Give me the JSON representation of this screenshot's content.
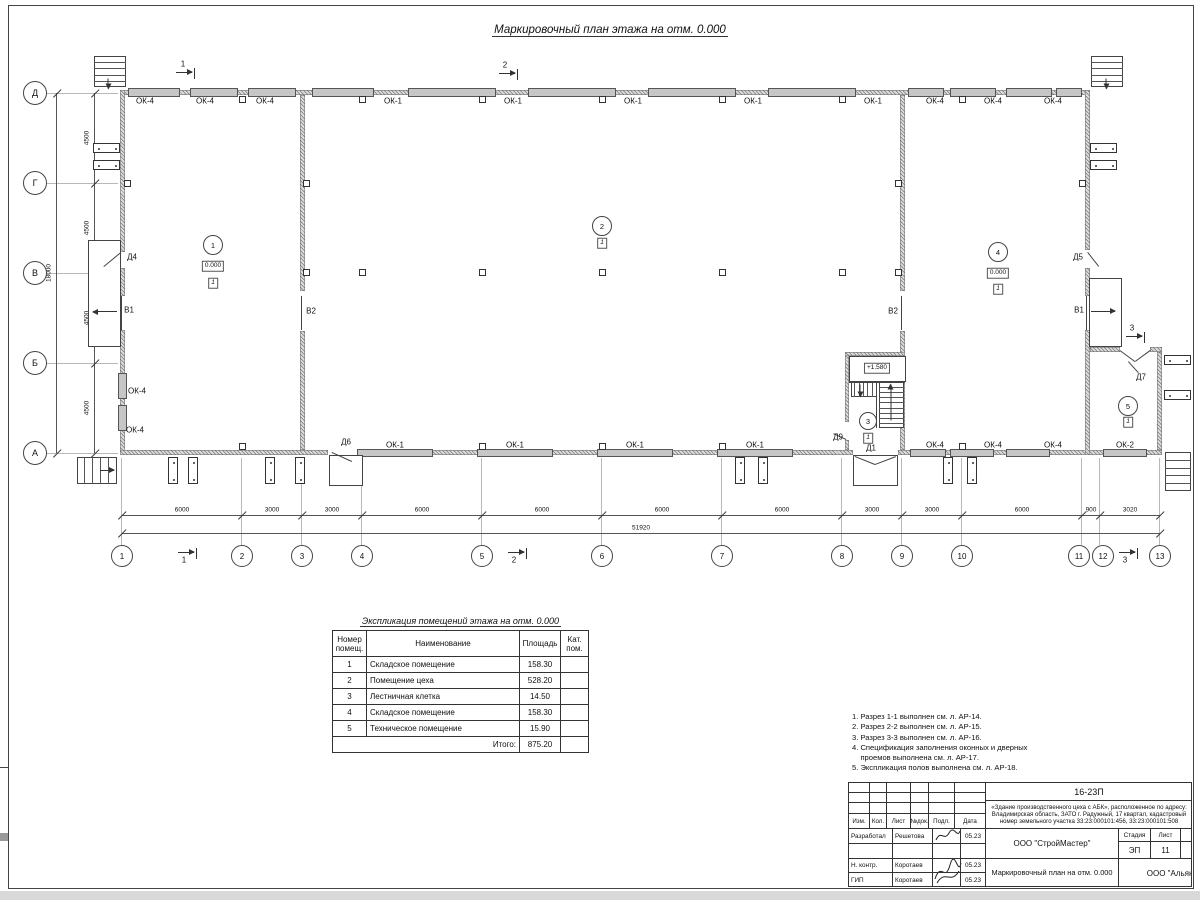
{
  "drawing_title": "Маркировочный план этажа на отм. 0.000",
  "plan": {
    "grid": {
      "gx": [
        122,
        242,
        302,
        362,
        482,
        602,
        722,
        842,
        902,
        962,
        1082,
        1100,
        1160
      ],
      "circle_x": [
        122,
        242,
        302,
        362,
        482,
        602,
        722,
        842,
        902,
        962,
        1079,
        1103,
        1160
      ],
      "numbers": [
        "1",
        "2",
        "3",
        "4",
        "5",
        "6",
        "7",
        "8",
        "9",
        "10",
        "11",
        "12",
        "13"
      ],
      "ay": [
        93,
        183,
        273,
        363,
        453
      ],
      "letters": [
        "Д",
        "Г",
        "В",
        "Б",
        "А"
      ],
      "spans": [
        "6000",
        "3000",
        "3000",
        "6000",
        "6000",
        "6000",
        "6000",
        "3000",
        "3000",
        "6000",
        "900",
        "3020"
      ],
      "total_w": "51920",
      "vspans": [
        "4500",
        "4500",
        "4500",
        "4500"
      ],
      "total_h": "18000"
    },
    "walls": [
      [
        120,
        90,
        970,
        5
      ],
      [
        120,
        90,
        5,
        162
      ],
      [
        120,
        268,
        5,
        28
      ],
      [
        120,
        330,
        5,
        125
      ],
      [
        120,
        450,
        208,
        5
      ],
      [
        362,
        450,
        491,
        5
      ],
      [
        898,
        450,
        264,
        5
      ],
      [
        1085,
        90,
        5,
        160
      ],
      [
        1085,
        268,
        5,
        28
      ],
      [
        1085,
        330,
        5,
        125
      ],
      [
        300,
        95,
        5,
        196
      ],
      [
        300,
        331,
        5,
        119
      ],
      [
        900,
        95,
        5,
        196
      ],
      [
        900,
        331,
        5,
        119
      ],
      [
        845,
        352,
        4,
        70
      ],
      [
        845,
        440,
        4,
        10
      ],
      [
        845,
        352,
        60,
        4
      ],
      [
        1090,
        347,
        30,
        5
      ],
      [
        1150,
        347,
        12,
        5
      ],
      [
        1157,
        352,
        5,
        98
      ]
    ],
    "windows": [
      [
        128,
        88,
        52,
        9
      ],
      [
        190,
        88,
        48,
        9
      ],
      [
        248,
        88,
        48,
        9
      ],
      [
        312,
        88,
        62,
        9
      ],
      [
        408,
        88,
        88,
        9
      ],
      [
        528,
        88,
        88,
        9
      ],
      [
        648,
        88,
        88,
        9
      ],
      [
        768,
        88,
        88,
        9
      ],
      [
        908,
        88,
        36,
        9
      ],
      [
        950,
        88,
        46,
        9
      ],
      [
        1006,
        88,
        46,
        9
      ],
      [
        1056,
        88,
        26,
        9
      ],
      [
        357,
        449,
        76,
        8
      ],
      [
        477,
        449,
        76,
        8
      ],
      [
        597,
        449,
        76,
        8
      ],
      [
        717,
        449,
        76,
        8
      ],
      [
        910,
        449,
        36,
        8
      ],
      [
        950,
        449,
        44,
        8
      ],
      [
        1006,
        449,
        44,
        8
      ],
      [
        1103,
        449,
        44,
        8
      ],
      [
        118,
        373,
        9,
        26
      ],
      [
        118,
        405,
        9,
        26
      ]
    ],
    "rects": [
      [
        88,
        240,
        33,
        107
      ],
      [
        1089,
        278,
        33,
        69
      ],
      [
        329,
        455,
        34,
        31
      ],
      [
        853,
        455,
        45,
        31
      ],
      [
        849,
        356,
        57,
        26
      ]
    ],
    "lines": [
      [
        302,
        296,
        302,
        330
      ],
      [
        902,
        296,
        902,
        330
      ],
      [
        122,
        296,
        122,
        330
      ],
      [
        1087,
        296,
        1087,
        330
      ],
      [
        877,
        382,
        877,
        428
      ],
      [
        849,
        382,
        905,
        382
      ],
      [
        1120,
        350,
        1135,
        361
      ],
      [
        1135,
        361,
        1150,
        350
      ],
      [
        855,
        456,
        875,
        464
      ],
      [
        875,
        464,
        896,
        456
      ],
      [
        121,
        253,
        104,
        267
      ],
      [
        1088,
        252,
        1099,
        266
      ],
      [
        332,
        452,
        352,
        461
      ],
      [
        846,
        440,
        833,
        434
      ],
      [
        1138,
        373,
        1128,
        362
      ]
    ],
    "squares": [
      [
        127,
        183
      ],
      [
        1082,
        183
      ],
      [
        306,
        183
      ],
      [
        306,
        272
      ],
      [
        898,
        183
      ],
      [
        898,
        272
      ],
      [
        362,
        272
      ],
      [
        482,
        272
      ],
      [
        602,
        272
      ],
      [
        722,
        272
      ],
      [
        842,
        272
      ],
      [
        242,
        99
      ],
      [
        362,
        99
      ],
      [
        482,
        99
      ],
      [
        602,
        99
      ],
      [
        722,
        99
      ],
      [
        842,
        99
      ],
      [
        962,
        99
      ],
      [
        242,
        446
      ],
      [
        482,
        446
      ],
      [
        602,
        446
      ],
      [
        722,
        446
      ],
      [
        962,
        446
      ]
    ],
    "pilasters": [
      [
        93,
        143,
        27,
        10
      ],
      [
        93,
        160,
        27,
        10
      ],
      [
        1090,
        143,
        27,
        10
      ],
      [
        1090,
        160,
        27,
        10
      ],
      [
        1164,
        355,
        27,
        10
      ],
      [
        1164,
        390,
        27,
        10
      ],
      [
        168,
        457,
        10,
        27
      ],
      [
        188,
        457,
        10,
        27
      ],
      [
        265,
        457,
        10,
        27
      ],
      [
        295,
        457,
        10,
        27
      ],
      [
        735,
        457,
        10,
        27
      ],
      [
        758,
        457,
        10,
        27
      ],
      [
        943,
        457,
        10,
        27
      ],
      [
        967,
        457,
        10,
        27
      ]
    ],
    "stairs": [
      [
        879,
        382,
        25,
        46,
        8,
        "h"
      ],
      [
        851,
        382,
        26,
        15,
        5,
        "v"
      ],
      [
        94,
        56,
        32,
        31,
        4,
        "h"
      ],
      [
        1091,
        56,
        32,
        31,
        4,
        "h"
      ],
      [
        77,
        457,
        40,
        27,
        4,
        "v"
      ],
      [
        1165,
        452,
        26,
        39,
        4,
        "h"
      ]
    ],
    "arrows": [
      [
        117,
        311,
        24,
        180,
        0
      ],
      [
        1091,
        311,
        24,
        0,
        0
      ],
      [
        100,
        470,
        14,
        0,
        0
      ],
      [
        108,
        78,
        10,
        90,
        0
      ],
      [
        1106,
        78,
        10,
        90,
        0
      ],
      [
        891,
        420,
        36,
        270,
        0
      ],
      [
        860,
        384,
        12,
        90,
        0
      ],
      [
        176,
        72,
        16,
        0,
        1
      ],
      [
        499,
        73,
        16,
        0,
        1
      ],
      [
        178,
        552,
        16,
        0,
        1
      ],
      [
        508,
        552,
        16,
        0,
        1
      ],
      [
        1119,
        552,
        16,
        0,
        1
      ],
      [
        1126,
        336,
        16,
        0,
        1
      ]
    ],
    "circles": [
      {
        "t": "1",
        "x": 213,
        "y": 245,
        "r": 10
      },
      {
        "t": "2",
        "x": 602,
        "y": 226,
        "r": 10
      },
      {
        "t": "3",
        "x": 868,
        "y": 421,
        "r": 9
      },
      {
        "t": "4",
        "x": 998,
        "y": 252,
        "r": 10
      },
      {
        "t": "5",
        "x": 1128,
        "y": 406,
        "r": 10
      }
    ],
    "boxed": [
      {
        "t": "0.000",
        "x": 213,
        "y": 266
      },
      {
        "t": "0.000",
        "x": 998,
        "y": 273
      },
      {
        "t": "+1.580",
        "x": 877,
        "y": 368
      },
      {
        "t": "1",
        "x": 213,
        "y": 283,
        "i": 1
      },
      {
        "t": "1",
        "x": 602,
        "y": 243,
        "i": 1
      },
      {
        "t": "1",
        "x": 868,
        "y": 438,
        "i": 1
      },
      {
        "t": "1",
        "x": 998,
        "y": 289,
        "i": 1
      },
      {
        "t": "1",
        "x": 1128,
        "y": 422,
        "i": 1
      }
    ],
    "labels": [
      {
        "t": "ОК-4",
        "x": 145,
        "y": 101
      },
      {
        "t": "ОК-4",
        "x": 205,
        "y": 101
      },
      {
        "t": "ОК-4",
        "x": 265,
        "y": 101
      },
      {
        "t": "ОК-1",
        "x": 393,
        "y": 101
      },
      {
        "t": "ОК-1",
        "x": 513,
        "y": 101
      },
      {
        "t": "ОК-1",
        "x": 633,
        "y": 101
      },
      {
        "t": "ОК-1",
        "x": 753,
        "y": 101
      },
      {
        "t": "ОК-1",
        "x": 873,
        "y": 101
      },
      {
        "t": "ОК-4",
        "x": 935,
        "y": 101
      },
      {
        "t": "ОК-4",
        "x": 993,
        "y": 101
      },
      {
        "t": "ОК-4",
        "x": 1053,
        "y": 101
      },
      {
        "t": "ОК-1",
        "x": 395,
        "y": 445
      },
      {
        "t": "ОК-1",
        "x": 515,
        "y": 445
      },
      {
        "t": "ОК-1",
        "x": 635,
        "y": 445
      },
      {
        "t": "ОК-1",
        "x": 755,
        "y": 445
      },
      {
        "t": "ОК-4",
        "x": 935,
        "y": 445
      },
      {
        "t": "ОК-4",
        "x": 993,
        "y": 445
      },
      {
        "t": "ОК-4",
        "x": 1053,
        "y": 445
      },
      {
        "t": "ОК-2",
        "x": 1125,
        "y": 445
      },
      {
        "t": "ОК-4",
        "x": 137,
        "y": 391
      },
      {
        "t": "ОК-4",
        "x": 135,
        "y": 430
      },
      {
        "t": "Д4",
        "x": 132,
        "y": 257
      },
      {
        "t": "Д5",
        "x": 1078,
        "y": 257
      },
      {
        "t": "Д6",
        "x": 346,
        "y": 442
      },
      {
        "t": "Д7",
        "x": 1141,
        "y": 377
      },
      {
        "t": "Д9",
        "x": 838,
        "y": 437
      },
      {
        "t": "Д1",
        "x": 871,
        "y": 448
      },
      {
        "t": "В1",
        "x": 129,
        "y": 310
      },
      {
        "t": "В2",
        "x": 311,
        "y": 311
      },
      {
        "t": "В2",
        "x": 893,
        "y": 311
      },
      {
        "t": "В1",
        "x": 1079,
        "y": 310
      },
      {
        "t": "1",
        "x": 183,
        "y": 64
      },
      {
        "t": "2",
        "x": 505,
        "y": 65
      },
      {
        "t": "1",
        "x": 184,
        "y": 560
      },
      {
        "t": "2",
        "x": 514,
        "y": 560
      },
      {
        "t": "3",
        "x": 1125,
        "y": 560
      },
      {
        "t": "3",
        "x": 1132,
        "y": 328
      }
    ]
  },
  "table": {
    "title": "Экспликация помещений этажа на отм. 0.000",
    "headers": [
      "Номер\nпомещ.",
      "Наименование",
      "Площадь",
      "Кат.\nпом."
    ],
    "rows": [
      [
        "1",
        "Складское помещение",
        "158.30",
        ""
      ],
      [
        "2",
        "Помещение цеха",
        "528.20",
        ""
      ],
      [
        "3",
        "Лестничная клетка",
        "14.50",
        ""
      ],
      [
        "4",
        "Складское помещение",
        "158.30",
        ""
      ],
      [
        "5",
        "Техническое помещение",
        "15.90",
        ""
      ]
    ],
    "total_label": "Итого:",
    "total": "875.20"
  },
  "notes": {
    "items": [
      "1. Разрез 1-1 выполнен см. л. АР-14.",
      "2. Разрез 2-2 выполнен см. л. АР-15.",
      "3. Разрез 3-3 выполнен см. л. АР-16.",
      "4. Спецификация заполнения оконных и дверных",
      "    проемов выполнена см. л. АР-17.",
      "5. Экспликация полов выполнена см. л. АР-18."
    ]
  },
  "titleblock": {
    "code": "16-23П",
    "object": "«Здание производственного цеха с АБК», расположенное по адресу: Владимирская область, ЗАТО г. Радужный, 17 квартал, кадастровый номер земельного участка 33:23:000101:456, 33:23:000101:508",
    "cols": [
      "Изм.",
      "Кол.",
      "Лист",
      "№док.",
      "Подл.",
      "Дата"
    ],
    "roles": [
      [
        "Разработал",
        "Решетова",
        "05.23"
      ],
      [
        "",
        "",
        ""
      ],
      [
        "Н. контр.",
        "Коротаев",
        "05.23"
      ],
      [
        "ГИП",
        "Коротаев",
        "05.23"
      ]
    ],
    "org": "ООО \"СтройМастер\"",
    "stage_label": "Стадия",
    "sheet_label": "Лист",
    "sheets_label": "Листов",
    "stage": "ЭП",
    "sheet": "11",
    "sheets": "1",
    "doc_name": "Маркировочный план на отм. 0.000",
    "org2": "ООО \"Альянс\""
  }
}
